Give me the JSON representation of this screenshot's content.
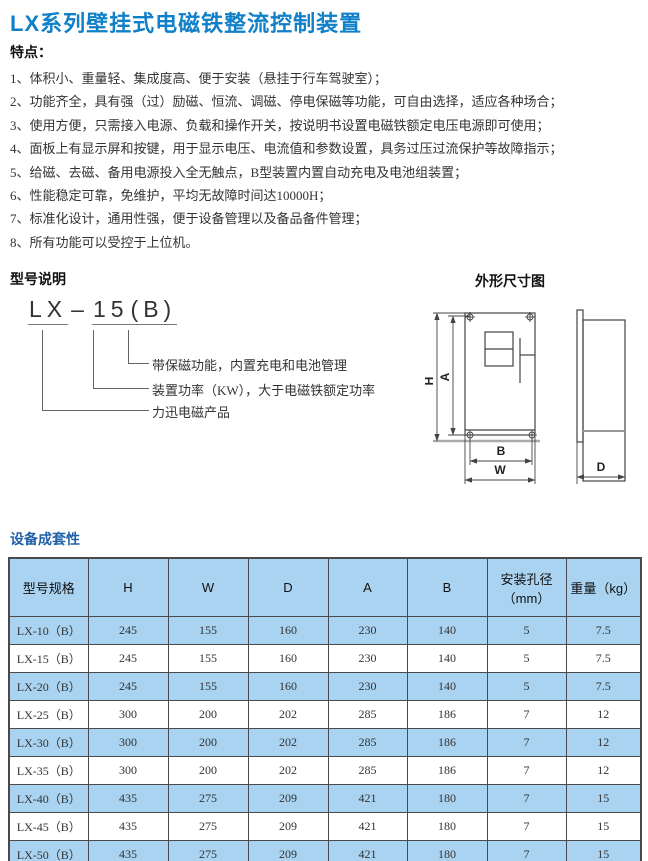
{
  "page": {
    "title": "LX系列壁挂式电磁铁整流控制装置",
    "accent_color": "#1080C8",
    "table_header_color": "#A9D3F0"
  },
  "features": {
    "heading": "特点：",
    "items": [
      "1、体积小、重量轻、集成度高、便于安装（悬挂于行车驾驶室）；",
      "2、功能齐全，具有强（过）励磁、恒流、调磁、停电保磁等功能，可自由选择，适应各种场合；",
      "3、使用方便，只需接入电源、负载和操作开关，按说明书设置电磁铁额定电压电源即可使用；",
      "4、面板上有显示屏和按键，用于显示电压、电流值和参数设置，具务过压过流保护等故障指示；",
      "5、给磁、去磁、备用电源投入全无触点，B型装置内置自动充电及电池组装置；",
      "6、性能稳定可靠，免维护，平均无故障时间达10000H；",
      "7、标准化设计，通用性强，便于设备管理以及备品备件管理；",
      "8、所有功能可以受控于上位机。"
    ]
  },
  "model_section": {
    "heading": "型号说明",
    "model": {
      "prefix": "LX",
      "dash": "–",
      "power": "15",
      "suffix": "(B)"
    },
    "explanations": [
      "带保磁功能，内置充电和电池管理",
      "装置功率（KW），大于电磁铁额定功率",
      "力迅电磁产品"
    ]
  },
  "dimension_drawing": {
    "heading": "外形尺寸图",
    "labels": {
      "h": "H",
      "a": "A",
      "b": "B",
      "w": "W",
      "d": "D"
    }
  },
  "table_section": {
    "heading": "设备成套性",
    "columns": [
      "型号规格",
      "H",
      "W",
      "D",
      "A",
      "B",
      "安装孔径\n（mm）",
      "重量（kg）"
    ],
    "rows": [
      {
        "model": "LX-10（B）",
        "h": "245",
        "w": "155",
        "d": "160",
        "a": "230",
        "b": "140",
        "hole": "5",
        "weight": "7.5"
      },
      {
        "model": "LX-15（B）",
        "h": "245",
        "w": "155",
        "d": "160",
        "a": "230",
        "b": "140",
        "hole": "5",
        "weight": "7.5"
      },
      {
        "model": "LX-20（B）",
        "h": "245",
        "w": "155",
        "d": "160",
        "a": "230",
        "b": "140",
        "hole": "5",
        "weight": "7.5"
      },
      {
        "model": "LX-25（B）",
        "h": "300",
        "w": "200",
        "d": "202",
        "a": "285",
        "b": "186",
        "hole": "7",
        "weight": "12"
      },
      {
        "model": "LX-30（B）",
        "h": "300",
        "w": "200",
        "d": "202",
        "a": "285",
        "b": "186",
        "hole": "7",
        "weight": "12"
      },
      {
        "model": "LX-35（B）",
        "h": "300",
        "w": "200",
        "d": "202",
        "a": "285",
        "b": "186",
        "hole": "7",
        "weight": "12"
      },
      {
        "model": "LX-40（B）",
        "h": "435",
        "w": "275",
        "d": "209",
        "a": "421",
        "b": "180",
        "hole": "7",
        "weight": "15"
      },
      {
        "model": "LX-45（B）",
        "h": "435",
        "w": "275",
        "d": "209",
        "a": "421",
        "b": "180",
        "hole": "7",
        "weight": "15"
      },
      {
        "model": "LX-50（B）",
        "h": "435",
        "w": "275",
        "d": "209",
        "a": "421",
        "b": "180",
        "hole": "7",
        "weight": "15"
      }
    ]
  }
}
